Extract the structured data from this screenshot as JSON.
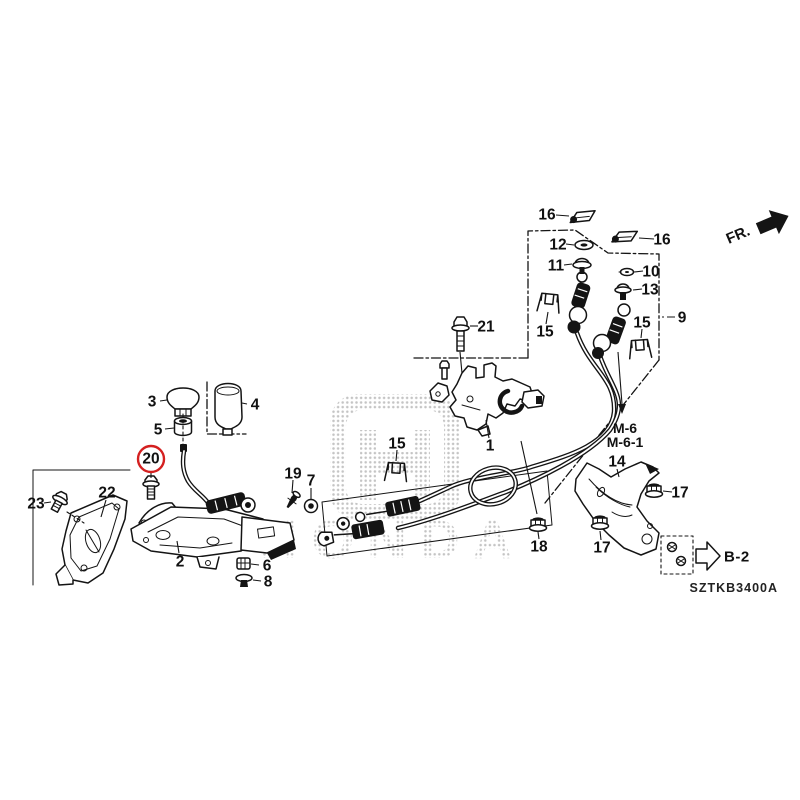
{
  "diagram": {
    "code": "SZTKB3400A",
    "direction_label": "FR.",
    "watermark": "HONDA",
    "ref_labels": {
      "m6": "M-6",
      "m6_1": "M-6-1",
      "b2": "B-2"
    },
    "colors": {
      "highlight": "#d42020",
      "line": "#141414",
      "watermark_dot": "#c4c4c4"
    },
    "highlighted_part": "20",
    "callouts": [
      {
        "n": "1",
        "x": 490,
        "y": 446,
        "leader": [
          489,
          438,
          486,
          420
        ]
      },
      {
        "n": "2",
        "x": 180,
        "y": 562,
        "leader": [
          179,
          553,
          177,
          541
        ]
      },
      {
        "n": "3",
        "x": 152,
        "y": 402,
        "leader": [
          160,
          401,
          167,
          400
        ]
      },
      {
        "n": "4",
        "x": 255,
        "y": 405,
        "leader": [
          247,
          404,
          242,
          403
        ]
      },
      {
        "n": "5",
        "x": 158,
        "y": 430,
        "leader": [
          165,
          429,
          174,
          428
        ]
      },
      {
        "n": "6",
        "x": 267,
        "y": 566,
        "leader": [
          259,
          565,
          251,
          564
        ]
      },
      {
        "n": "7",
        "x": 311,
        "y": 481,
        "leader": [
          311,
          488,
          311,
          499
        ]
      },
      {
        "n": "8",
        "x": 268,
        "y": 582,
        "leader": [
          261,
          581,
          253,
          580
        ]
      },
      {
        "n": "9",
        "x": 682,
        "y": 318,
        "leader": [
          675,
          317,
          660,
          317
        ],
        "style": "dashdot"
      },
      {
        "n": "10",
        "x": 651,
        "y": 272,
        "leader": [
          643,
          271,
          634,
          272
        ]
      },
      {
        "n": "11",
        "x": 556,
        "y": 266,
        "leader": [
          564,
          265,
          572,
          264
        ]
      },
      {
        "n": "12",
        "x": 558,
        "y": 245,
        "leader": [
          566,
          244,
          574,
          245
        ]
      },
      {
        "n": "13",
        "x": 650,
        "y": 290,
        "leader": [
          642,
          289,
          633,
          290
        ]
      },
      {
        "n": "14",
        "x": 617,
        "y": 462,
        "leader": [
          617,
          469,
          619,
          477
        ]
      },
      {
        "n": "15",
        "x": 545,
        "y": 332,
        "leader": [
          546,
          324,
          548,
          312
        ]
      },
      {
        "n": "15",
        "x": 642,
        "y": 323,
        "leader": [
          642,
          329,
          641,
          338
        ]
      },
      {
        "n": "15",
        "x": 397,
        "y": 444,
        "leader": [
          397,
          450,
          396,
          461
        ]
      },
      {
        "n": "16",
        "x": 547,
        "y": 215,
        "leader": [
          556,
          215,
          569,
          216
        ]
      },
      {
        "n": "16",
        "x": 662,
        "y": 240,
        "leader": [
          654,
          239,
          639,
          238
        ]
      },
      {
        "n": "17",
        "x": 680,
        "y": 493,
        "leader": [
          672,
          492,
          663,
          491
        ]
      },
      {
        "n": "17",
        "x": 602,
        "y": 548,
        "leader": [
          601,
          540,
          600,
          531
        ]
      },
      {
        "n": "18",
        "x": 539,
        "y": 547,
        "leader": [
          539,
          539,
          538,
          532
        ]
      },
      {
        "n": "19",
        "x": 293,
        "y": 474,
        "leader": [
          293,
          480,
          292,
          493
        ]
      },
      {
        "n": "20",
        "x": 151,
        "y": 459,
        "circled": true,
        "leader": [
          151,
          473,
          151,
          478
        ]
      },
      {
        "n": "21",
        "x": 486,
        "y": 327,
        "leader": [
          478,
          326,
          470,
          326
        ]
      },
      {
        "n": "22",
        "x": 107,
        "y": 493,
        "leader": [
          106,
          500,
          101,
          517
        ]
      },
      {
        "n": "23",
        "x": 36,
        "y": 504,
        "leader": [
          44,
          503,
          51,
          502
        ]
      }
    ]
  }
}
